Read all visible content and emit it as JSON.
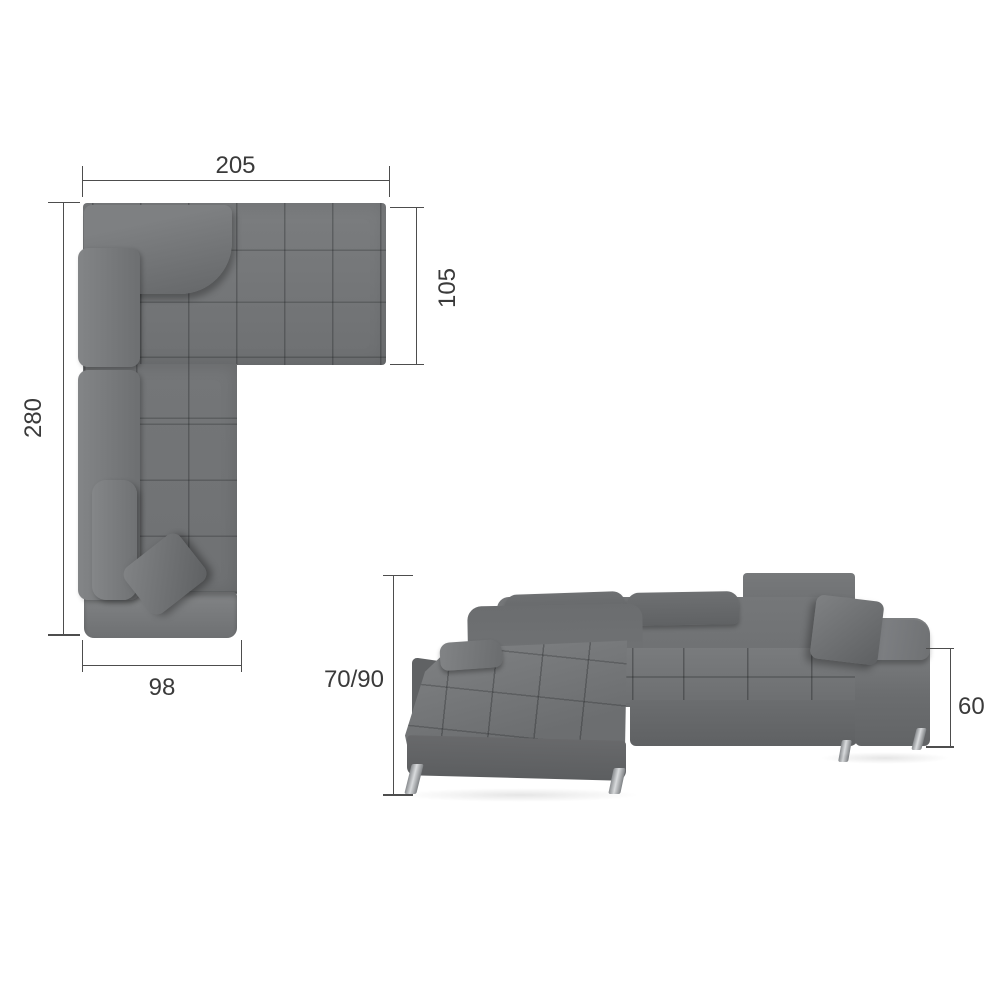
{
  "product": {
    "views": {
      "top": {
        "dims": {
          "back_width": "205",
          "right_section_depth": "105",
          "left_section_length": "280",
          "chaise_end_width": "98"
        }
      },
      "front": {
        "dims": {
          "backrest_height": "70/90",
          "armrest_height": "60"
        }
      }
    }
  },
  "colors": {
    "background": "#ffffff",
    "sofa_base": "#727476",
    "sofa_light": "#7f8183",
    "sofa_dark": "#5d5f61",
    "seam": "#3f4143",
    "dim_line": "#4d4d4d",
    "dim_text": "#3a3a3a",
    "leg_chrome": "#c7cacc"
  }
}
